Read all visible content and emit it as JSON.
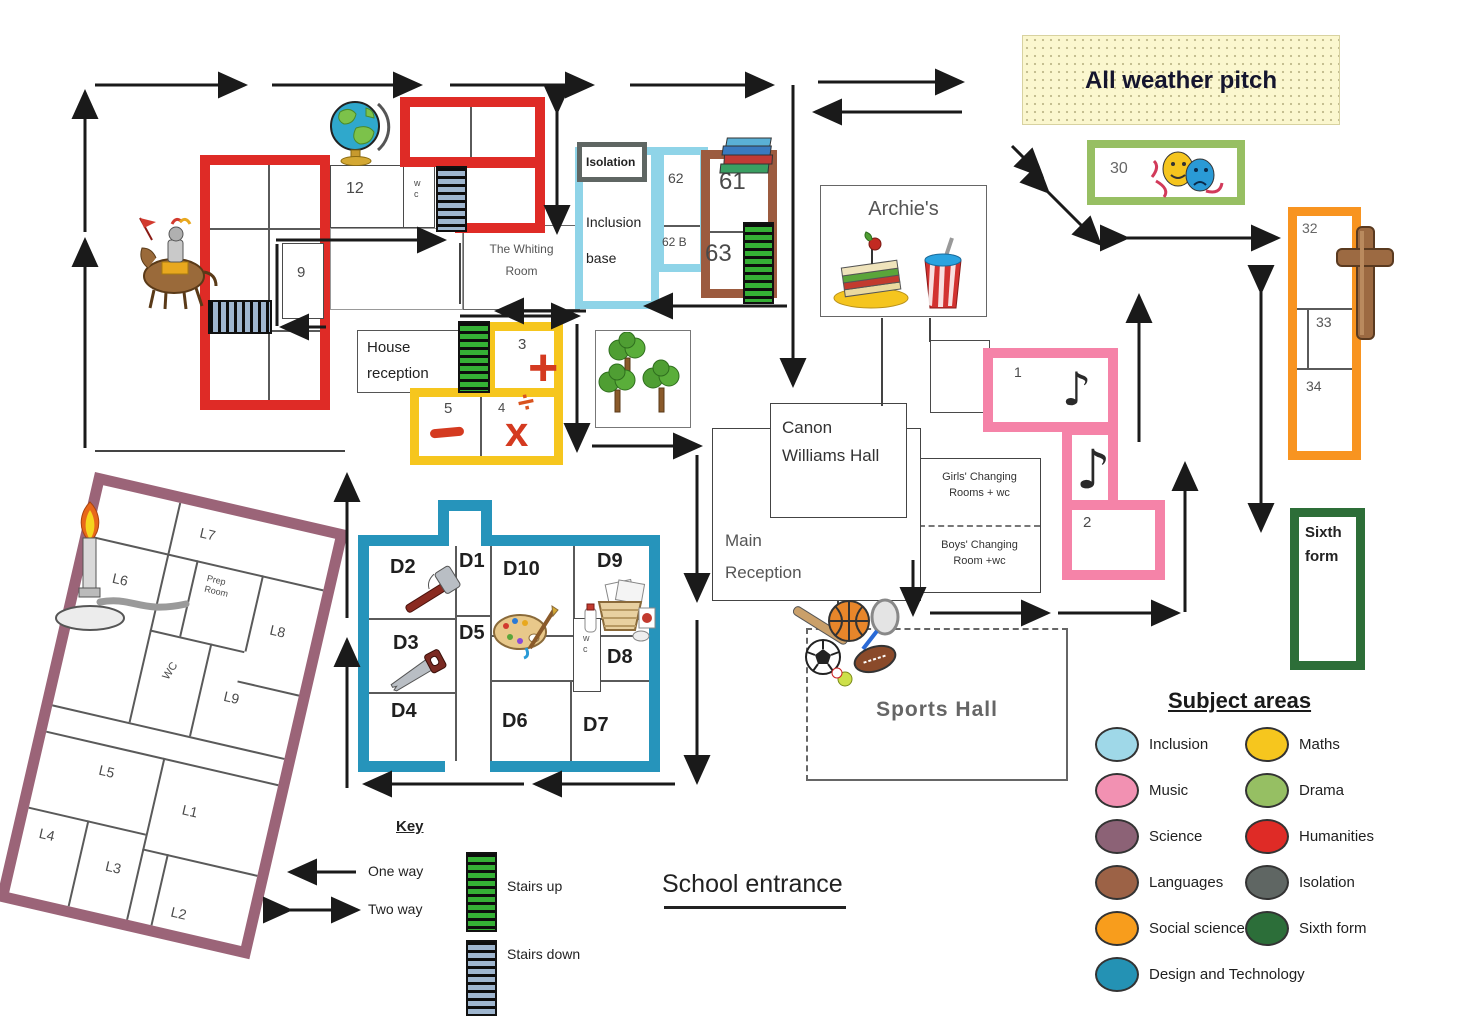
{
  "areas": {
    "all_weather_pitch": "All weather pitch",
    "humanities": {
      "r10": "10",
      "r11": "11",
      "r12": "12",
      "wc": "w c",
      "r13": "13",
      "r15": "15",
      "r14": "14",
      "r8": "8",
      "r9": "9",
      "r7": "7",
      "r6": "6",
      "whiting_1": "The Whiting",
      "whiting_2": "Room"
    },
    "house_reception": {
      "l1": "House",
      "l2": "reception"
    },
    "maths": {
      "r3": "3",
      "r4": "4",
      "r5": "5",
      "plus": "+",
      "divide": "÷",
      "times": "x"
    },
    "isolation_label": "Isolation",
    "inclusion": {
      "l1": "Inclusion",
      "l2": "base",
      "r62": "62",
      "r62b": "62 B"
    },
    "languages": {
      "r61": "61",
      "r63": "63"
    },
    "archies": "Archie's",
    "drama": {
      "r30": "30"
    },
    "social_sciences": {
      "r32": "32",
      "r33": "33",
      "r34": "34"
    },
    "music": {
      "r1": "1",
      "r2": "2",
      "note": "♪"
    },
    "sixth_form": {
      "l1": "Sixth",
      "l2": "form"
    },
    "canon_hall": {
      "l1": "Canon",
      "l2": "Williams Hall"
    },
    "main_reception": {
      "l1": "Main",
      "l2": "Reception"
    },
    "changing": {
      "girls_1": "Girls' Changing",
      "girls_2": "Rooms + wc",
      "boys_1": "Boys' Changing",
      "boys_2": "Room +wc"
    },
    "sports_hall": "Sports Hall",
    "dt": {
      "d1": "D1",
      "d2": "D2",
      "d3": "D3",
      "d4": "D4",
      "d5": "D5",
      "d6": "D6",
      "d7": "D7",
      "d8": "D8",
      "d9": "D9",
      "d10": "D10",
      "wc": "w c"
    },
    "science": {
      "l1": "L1",
      "l2": "L2",
      "l3": "L3",
      "l4": "L4",
      "l5": "L5",
      "l6": "L6",
      "l7": "L7",
      "l8": "L8",
      "l9": "L9",
      "prep_1": "Prep",
      "prep_2": "Room",
      "wc": "WC"
    }
  },
  "key": {
    "title": "Key",
    "one_way": "One way",
    "two_way": "Two way",
    "stairs_up": "Stairs up",
    "stairs_down": "Stairs down"
  },
  "school_entrance": "School entrance",
  "subject_areas": {
    "title": "Subject areas",
    "items": [
      {
        "label": "Inclusion",
        "color": "#9fd8e8"
      },
      {
        "label": "Music",
        "color": "#f291b2"
      },
      {
        "label": "Science",
        "color": "#8c6276"
      },
      {
        "label": "Languages",
        "color": "#9c6246"
      },
      {
        "label": "Social sciences",
        "color": "#f89d1c"
      },
      {
        "label": "Design and Technology",
        "color": "#2492b4"
      },
      {
        "label": "Maths",
        "color": "#f6c61e"
      },
      {
        "label": "Drama",
        "color": "#96bf63"
      },
      {
        "label": "Humanities",
        "color": "#df2b26"
      },
      {
        "label": "Isolation",
        "color": "#5f6663"
      },
      {
        "label": "Sixth form",
        "color": "#2c6e39"
      }
    ]
  }
}
